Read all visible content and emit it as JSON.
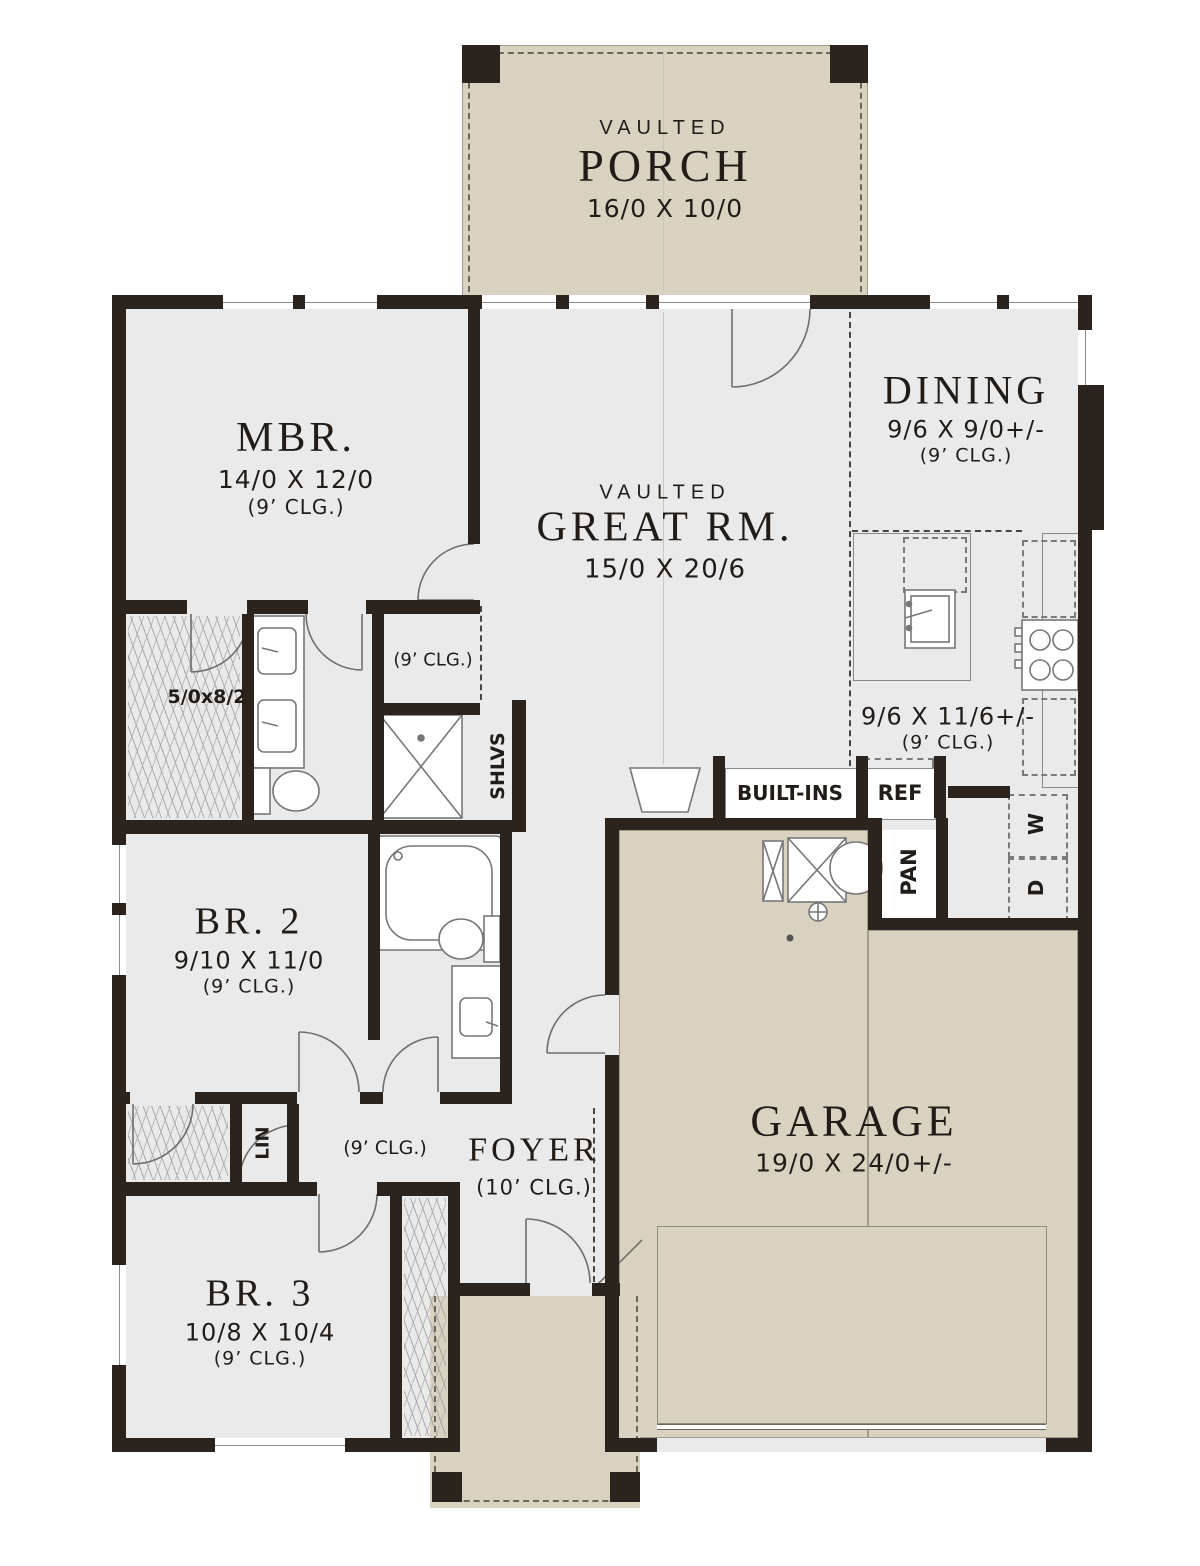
{
  "rooms": {
    "porch": {
      "tag": "VAULTED",
      "name": "PORCH",
      "dims": "16/0 X 10/0"
    },
    "mbr": {
      "name": "MBR.",
      "dims": "14/0 X 12/0",
      "ceiling": "(9’ CLG.)"
    },
    "great_room": {
      "tag": "VAULTED",
      "name": "GREAT RM.",
      "dims": "15/0 X 20/6"
    },
    "dining": {
      "name": "DINING",
      "dims": "9/6 X 9/0+/-",
      "ceiling": "(9’ CLG.)"
    },
    "kitchen": {
      "dims": "9/6 X 11/6+/-",
      "ceiling": "(9’ CLG.)"
    },
    "bedroom2": {
      "name": "BR. 2",
      "dims": "9/10 X 11/0",
      "ceiling": "(9’ CLG.)"
    },
    "bedroom3": {
      "name": "BR. 3",
      "dims": "10/8 X 10/4",
      "ceiling": "(9’ CLG.)"
    },
    "foyer": {
      "name": "FOYER",
      "ceiling": "(10’ CLG.)"
    },
    "garage": {
      "name": "GARAGE",
      "dims": "19/0 X 24/0+/-"
    }
  },
  "labels": {
    "master_closet_dims": "5/0x8/2",
    "mbr_hall_ceiling": "(9’ CLG.)",
    "shelves": "SHLVS",
    "hall_ceiling": "(9’ CLG.)",
    "linen": "LIN",
    "built_ins": "BUILT-INS",
    "refrigerator": "REF",
    "pantry": "PAN",
    "washer": "W",
    "dryer": "D"
  },
  "colors": {
    "wall": "#2a231e",
    "interior_floor": "#eaeaea",
    "outdoor_floor": "#d9d2c0",
    "text": "#221c18"
  }
}
